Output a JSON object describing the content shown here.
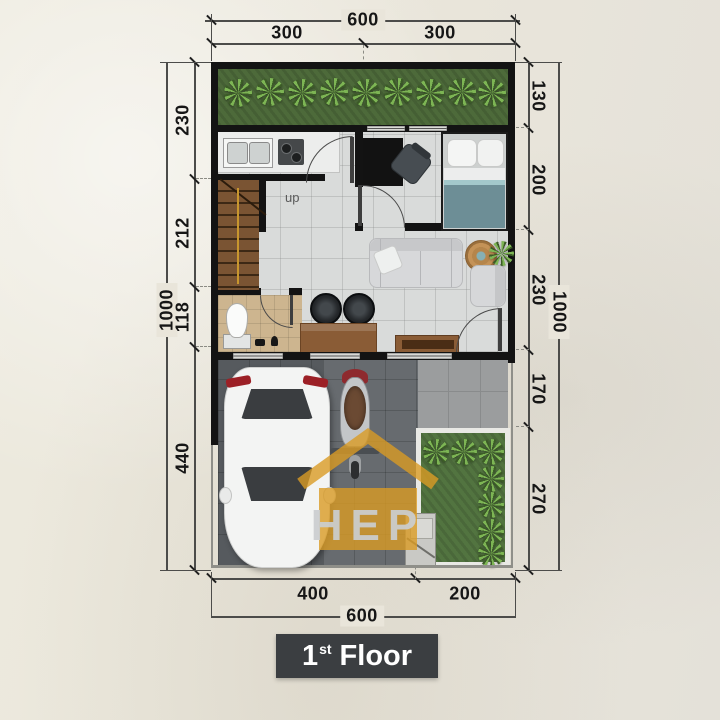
{
  "floor_label": {
    "number": "1",
    "ordinal": "st",
    "word": "Floor"
  },
  "stairs": {
    "label": "up"
  },
  "watermark": {
    "text": "HEP",
    "color": "#d99b24"
  },
  "dimensions": {
    "top": {
      "total": "600",
      "segments": [
        "300",
        "300"
      ]
    },
    "bottom": {
      "total": "600",
      "segments": [
        "400",
        "200"
      ]
    },
    "left": {
      "total": "1000",
      "segments": [
        "230",
        "212",
        "118",
        "440"
      ]
    },
    "right": {
      "total": "1000",
      "segments": [
        "130",
        "200",
        "230",
        "170",
        "270"
      ]
    }
  },
  "colors": {
    "wall": "#131313",
    "grass": "#4d6a3a",
    "wood": "#8a5c36",
    "carport_paving": "#565a5e",
    "floor_tile": "#d9dbda",
    "bath_floor": "#cdb58f",
    "label_box": "#3b3e41",
    "accent_orange": "#d99b24"
  }
}
